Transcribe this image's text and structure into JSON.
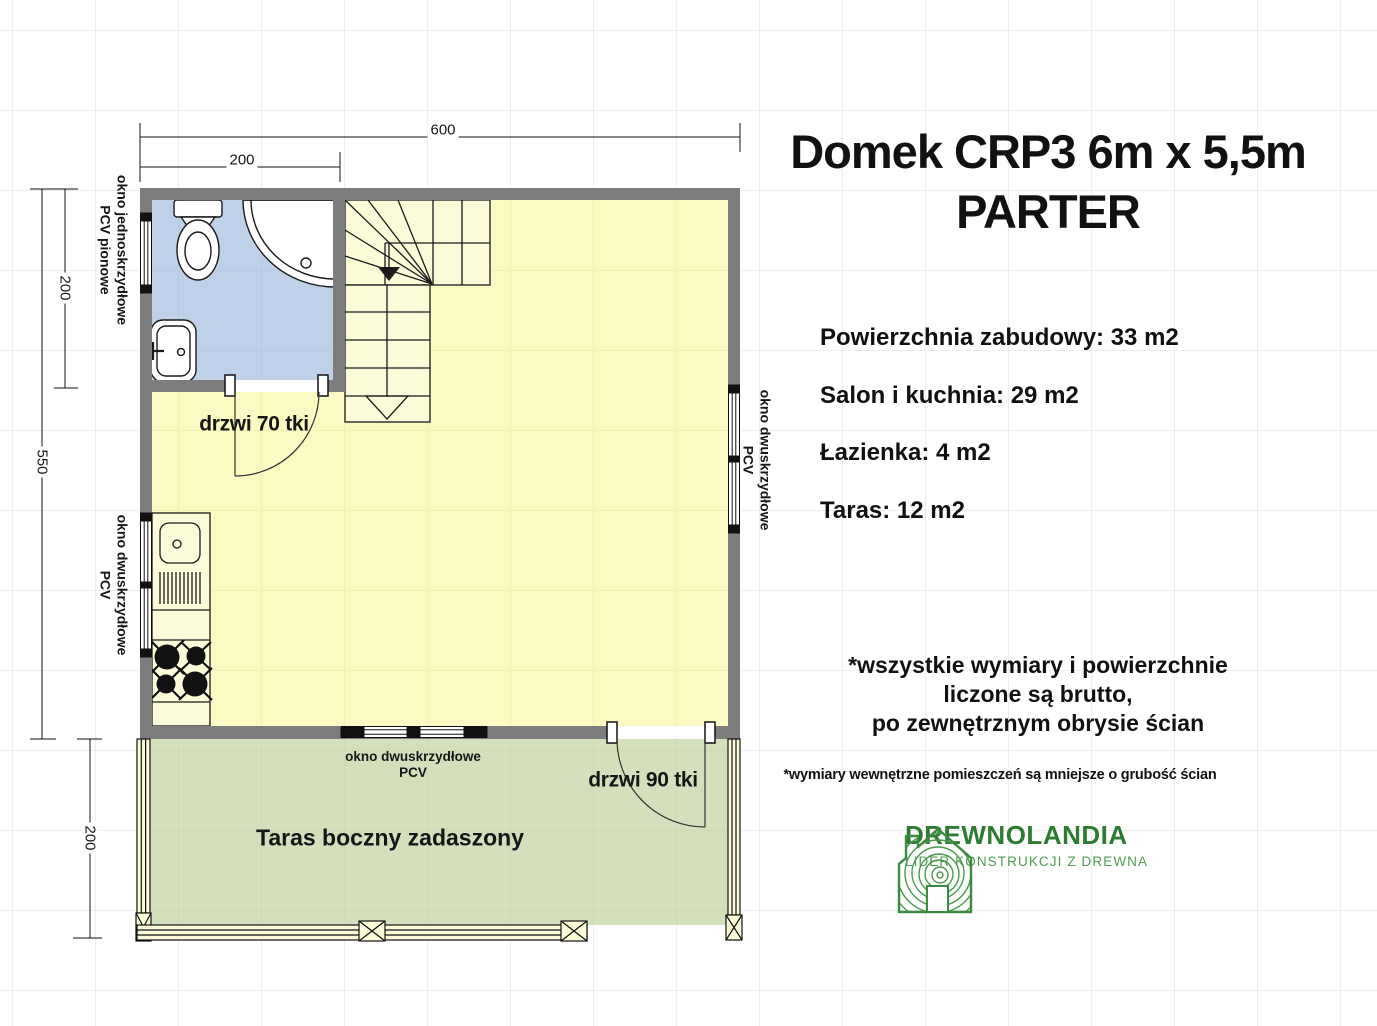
{
  "title": {
    "line1": "Domek CRP3 6m x 5,5m",
    "line2": "PARTER"
  },
  "stats": [
    "Powierzchnia zabudowy: 33 m2",
    "Salon i kuchnia: 29 m2",
    "Łazienka: 4 m2",
    "Taras: 12 m2"
  ],
  "notes": {
    "main": "*wszystkie wymiary i powierzchnie\nliczone są brutto,\npo zewnętrznym obrysie ścian",
    "small": "*wymiary wewnętrzne pomieszczeń są mniejsze o grubość ścian"
  },
  "logo": {
    "name": "DREWNOLANDIA",
    "tagline": "LIDER KONSTRUKCJI Z DREWNA"
  },
  "plan": {
    "dimensions": {
      "width_total": "600",
      "width_bathroom": "200",
      "height_total": "550",
      "height_bathroom": "200",
      "height_terrace": "200"
    },
    "labels": {
      "window_left_top": "okno jednoskrzydłowe\nPCV pionowe",
      "window_left_bottom": "okno dwuskrzydłowe\nPCV",
      "window_right": "okno dwuskrzydłowe\nPCV",
      "window_bottom": "okno dwuskrzydłowe\nPCV",
      "door_bathroom": "drzwi 70 tki",
      "door_terrace": "drzwi 90 tki",
      "terrace": "Taras boczny zadaszony"
    }
  },
  "colors": {
    "wall": "#7d7d7d",
    "floor": "#fbfac3",
    "bathroom": "#bfd1e8",
    "terrace": "#d4e0bc",
    "logo_green": "#2e7c33",
    "logo_light_green": "#4f9b53"
  }
}
